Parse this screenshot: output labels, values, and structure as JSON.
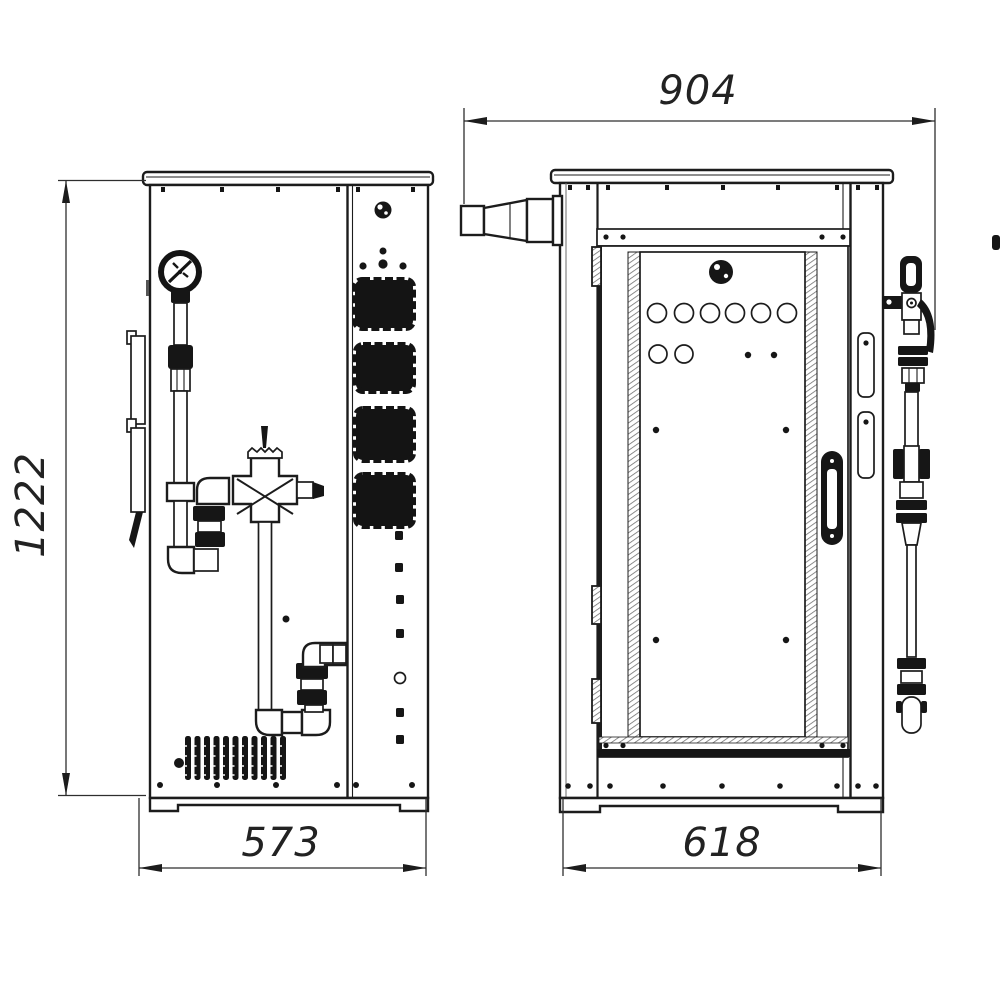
{
  "drawing": {
    "type": "engineering-two-view-cabinet-drawing",
    "background_color": "#ffffff",
    "line_color": "#1c1c1c",
    "dimension_color": "#2e2e2e",
    "dimensions": {
      "depth": {
        "label": "904"
      },
      "height": {
        "label": "1222"
      },
      "side_width": {
        "label": "573"
      },
      "front_width": {
        "label": "618"
      }
    },
    "views": {
      "side": {
        "name": "left-side-view",
        "components": [
          "pressure-gauge",
          "riser-pipe",
          "cross-valve",
          "drain-loop-pipe",
          "finned-element",
          "vent-blocks",
          "panel-knob",
          "mounting-brackets"
        ]
      },
      "front": {
        "name": "front-view",
        "components": [
          "inlet-nozzle",
          "cabinet-door",
          "door-knob",
          "indicator-holes",
          "door-handle",
          "door-hinges",
          "sight-glass",
          "external-valve",
          "external-pipe",
          "wall-slots"
        ]
      }
    }
  }
}
